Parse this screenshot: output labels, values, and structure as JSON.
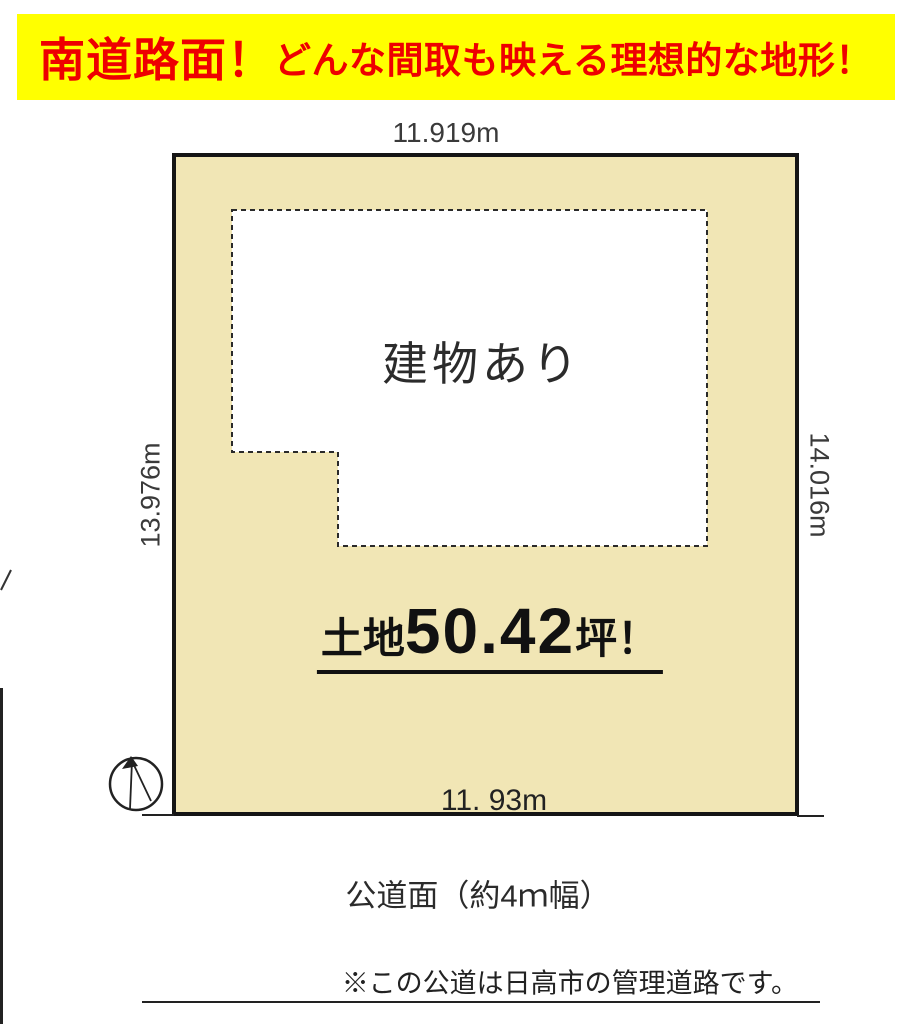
{
  "banner": {
    "main": "南道路面！",
    "sub": "どんな間取も映える理想的な地形！",
    "bg_color": "#ffff00",
    "text_color": "#ee0000"
  },
  "plot": {
    "dim_top": "11.919m",
    "dim_left": "13.976m",
    "dim_right": "14.016m",
    "dim_bottom": "11. 93m",
    "building_label": "建物あり",
    "area_prefix": "土地",
    "area_value": "50.42",
    "area_suffix": "坪！",
    "fill_color": "#f1e6b5",
    "border_color": "#151515"
  },
  "road": {
    "label": "公道面（約4ｍ幅）",
    "note": "※この公道は日高市の管理道路です。"
  },
  "icons": {
    "compass": "north-compass-icon"
  }
}
